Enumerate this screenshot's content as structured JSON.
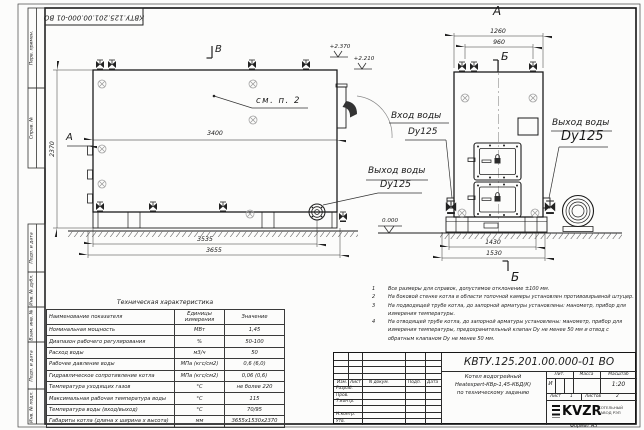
{
  "sheet": {
    "stamp_top": "КВТУ.125.201.00.000-01 ВО",
    "format_label": "Формат А3",
    "side_labels": [
      "Перв. примен.",
      "Справ. №",
      "Подп. и дата",
      "Инв. № дубл.",
      "Взам. инв. №",
      "Подп. и дата",
      "Инв. № подл."
    ]
  },
  "views": {
    "left": {
      "mark_top": "В",
      "mark_side": "А",
      "note_ref": "см. п. 2",
      "elev_top": "+2.370",
      "elev_pipe": "+2.210",
      "dim_length": "3400",
      "dim_height": "2370",
      "dim_base_inner": "3535",
      "dim_base_outer": "3655",
      "outlet_title": "Выход воды",
      "outlet_size": "Dy125"
    },
    "front": {
      "view_label": "А",
      "section_top": "Б",
      "section_bottom": "Б",
      "dim_top_outer": "1260",
      "dim_top_inner": "960",
      "dim_base_inner": "1430",
      "dim_base_outer": "1530",
      "elev_zero": "0.000",
      "inlet_title": "Вход воды",
      "inlet_size": "Dy125",
      "outlet_title": "Выход воды",
      "outlet_size": "Dy125"
    }
  },
  "notes": {
    "items": [
      {
        "num": "1",
        "text": "Все размеры для справок, допустимое отклонение ±100 мм."
      },
      {
        "num": "2",
        "text": "На боковой стенке котла в области топочной камеры установлен противовзрывной штуцер."
      },
      {
        "num": "3",
        "text": "На подводящей трубе котла, до запорной арматуры установлены: манометр, прибор для измерения температуры."
      },
      {
        "num": "4",
        "text": "На отводящей трубе котла, до запорной арматуры установлены: манометр, прибор для измерения температуры, предохранительный клапан Dу не менее 50 мм и отвод с обратным клапаном Dу не менее 50 мм."
      }
    ]
  },
  "tech_table": {
    "title": "Техническая характеристика",
    "col_name": "Наименование показателя",
    "col_units": "Единицы измерения",
    "col_value": "Значение",
    "rows": [
      {
        "name": "Номинальная мощность",
        "units": "МВт",
        "value": "1,45"
      },
      {
        "name": "Диапазон рабочего регулирования",
        "units": "%",
        "value": "50-100"
      },
      {
        "name": "Расход воды",
        "units": "м3/ч",
        "value": "50"
      },
      {
        "name": "Рабочее давление воды",
        "units": "МПа (кгс/см2)",
        "value": "0,6 (6,0)"
      },
      {
        "name": "Гидравлическое сопротивление котла",
        "units": "МПа (кгс/см2)",
        "value": "0,06 (0,6)"
      },
      {
        "name": "Температура уходящих газов",
        "units": "°С",
        "value": "не более 220"
      },
      {
        "name": "Максимальная рабочая температура воды",
        "units": "°С",
        "value": "115"
      },
      {
        "name": "Температура воды (вход/выход)",
        "units": "°С",
        "value": "70/95"
      },
      {
        "name": "Габариты котла (длина х ширина х высота)",
        "units": "мм",
        "value": "3655х1530х2370"
      }
    ]
  },
  "title_block": {
    "doc_number": "КВТУ.125.201.00.000-01 ВО",
    "name_line1": "Котел водогрейный",
    "name_line2": "Heatexpert-КВр-1,45-КБД(К)",
    "name_line3": "по техническому заданию",
    "hdr_izm": "Изм.",
    "hdr_list": "Лист",
    "hdr_doc": "N докум.",
    "hdr_sign": "Подп.",
    "hdr_date": "Дата",
    "role_1": "Разраб.",
    "role_2": "Пров.",
    "role_3": "Т.контр.",
    "role_4": "Н.контр.",
    "role_5": "Утв.",
    "lit_label": "Лит.",
    "mass_label": "Масса",
    "scale_label": "Масштаб",
    "lit_value": "И",
    "scale_value": "1:20",
    "sheet_label": "Лист",
    "sheet_value": "1",
    "sheets_label": "Листов",
    "sheets_value": "2",
    "logo": "KVZR",
    "logo_sub1": "КОТЕЛЬНЫЙ",
    "logo_sub2": "ЗАВОД РЭП"
  }
}
